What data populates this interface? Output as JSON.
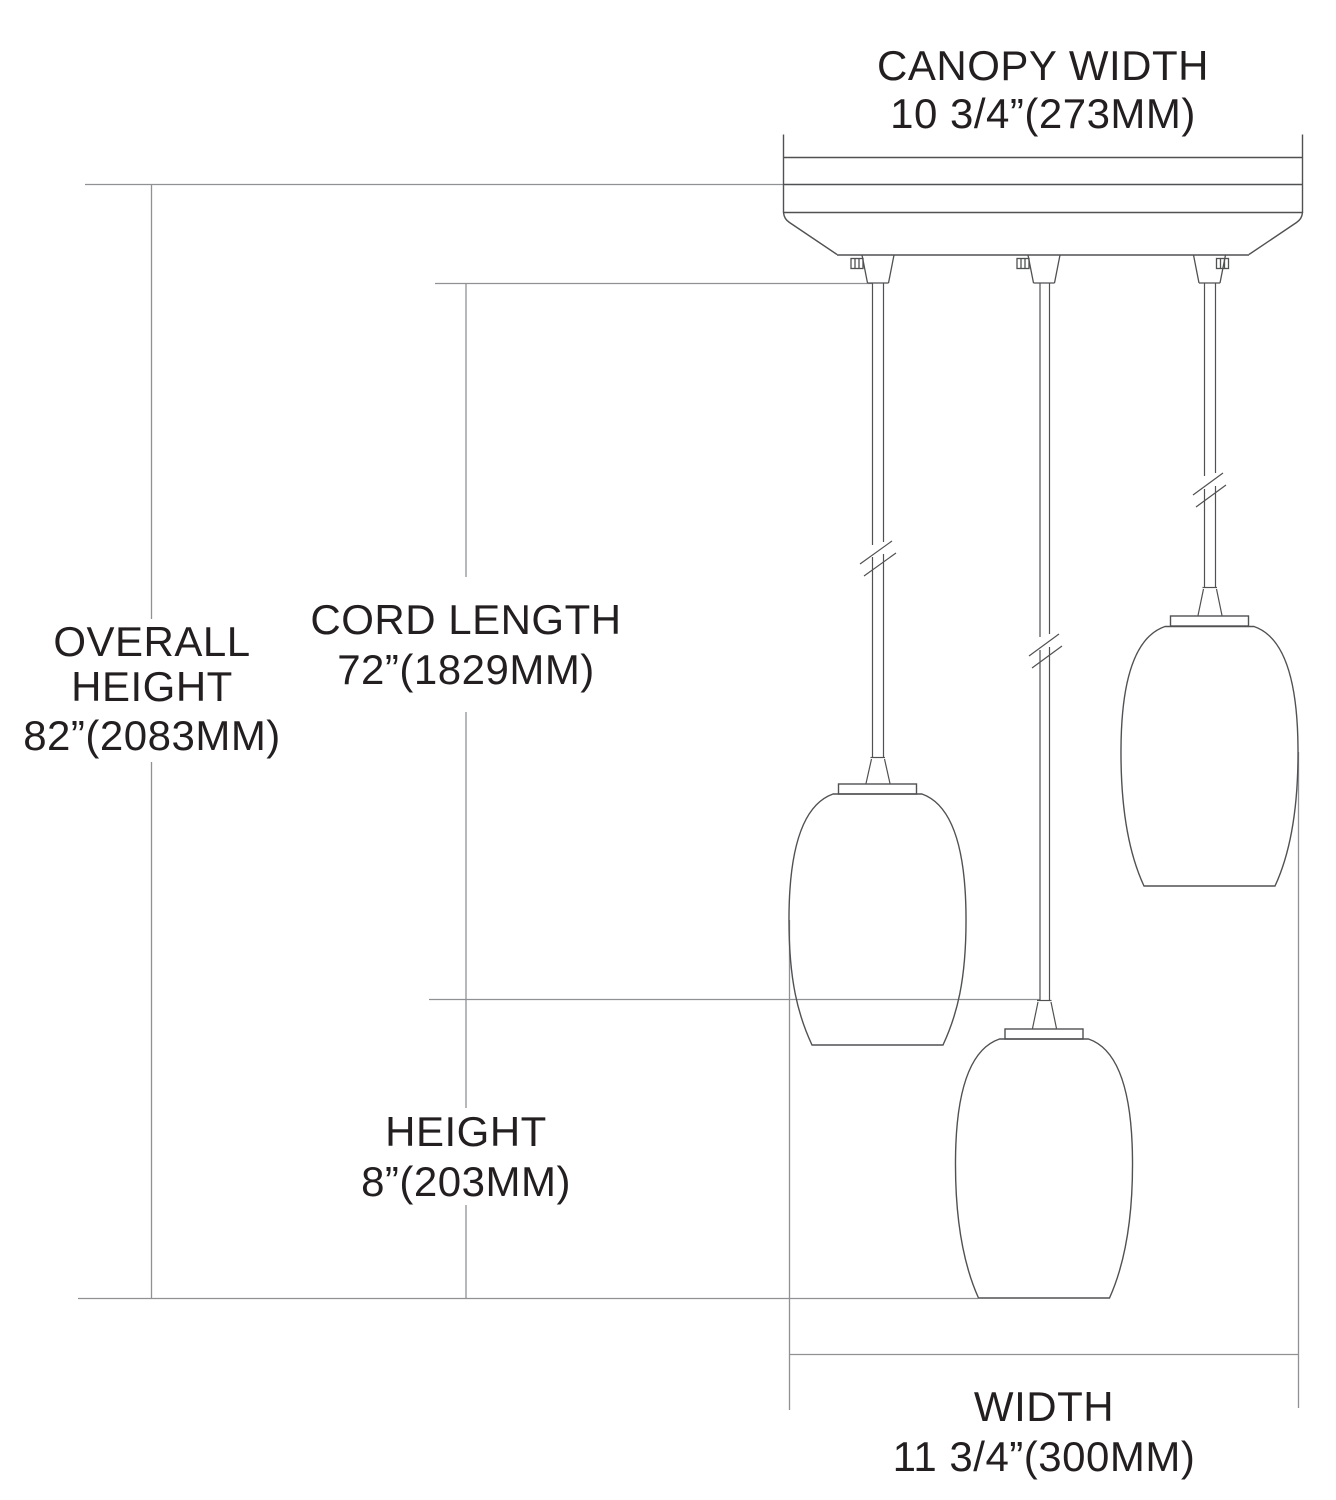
{
  "diagram": {
    "type": "dimension-drawing",
    "pendant_count": 3,
    "labels": {
      "canopy_width": {
        "title": "CANOPY WIDTH",
        "value": "10 3/4”(273MM)"
      },
      "overall_height": {
        "title_line1": "OVERALL",
        "title_line2": "HEIGHT",
        "value": "82”(2083MM)"
      },
      "cord_length": {
        "title": "CORD LENGTH",
        "value": "72”(1829MM)"
      },
      "height": {
        "title": "HEIGHT",
        "value": "8”(203MM)"
      },
      "width": {
        "title": "WIDTH",
        "value": "11 3/4”(300MM)"
      }
    },
    "colors": {
      "background": "#ffffff",
      "text": "#231f20",
      "dimension_line": "#8f9194",
      "drawing_line": "#505153"
    }
  }
}
